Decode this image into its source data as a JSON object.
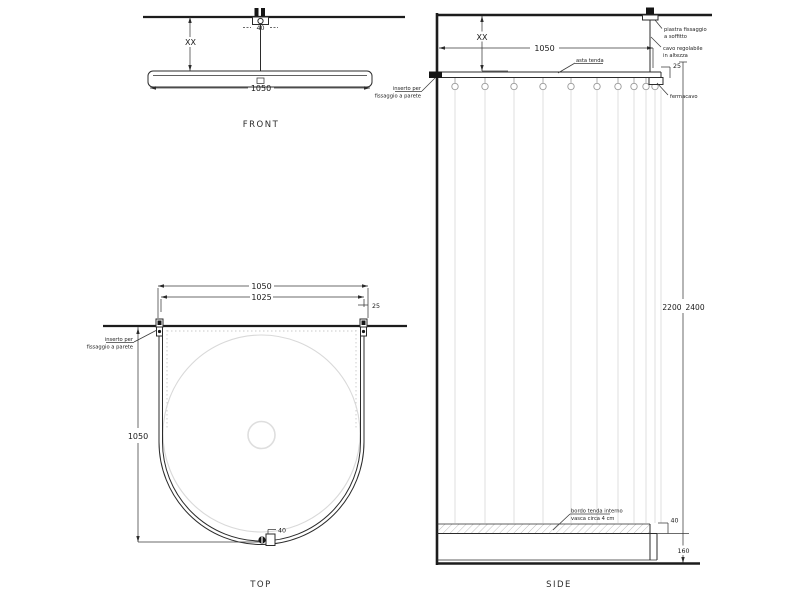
{
  "palette": {
    "line": "#2b2b2b",
    "light_line": "#dcdcdc",
    "background": "#ffffff"
  },
  "views": {
    "front": {
      "caption": "FRONT",
      "dim_plate": "40",
      "dim_height": "XX",
      "dim_width": "1050"
    },
    "top": {
      "caption": "TOP",
      "dim_outer_width": "1050",
      "dim_inner_width": "1025",
      "dim_side_offset": "25",
      "dim_depth": "1050",
      "dim_fixture": "40",
      "label_wall_insert_line1": "inserto per",
      "label_wall_insert_line2": "fissaggio a parete"
    },
    "side": {
      "caption": "SIDE",
      "dim_height_adjust": "XX",
      "dim_rod_length": "1050",
      "dim_rod_offset": "25",
      "dim_total_height_min": "2200",
      "dim_total_height_max": "2400",
      "dim_curtain_overlap": "40",
      "dim_tub_height": "160",
      "label_ceiling_plate_line1": "piastra fissaggio",
      "label_ceiling_plate_line2": "a soffitto",
      "label_cable_line1": "cavo regolabile",
      "label_cable_line2": "in altezza",
      "label_rod": "asta tenda",
      "label_cable_stop": "fermacavo",
      "label_wall_insert_line1": "inserto per",
      "label_wall_insert_line2": "fissaggio a parete",
      "label_curtain_edge_line1": "bordo tenda interno",
      "label_curtain_edge_line2": "vasca circa 4 cm"
    }
  }
}
